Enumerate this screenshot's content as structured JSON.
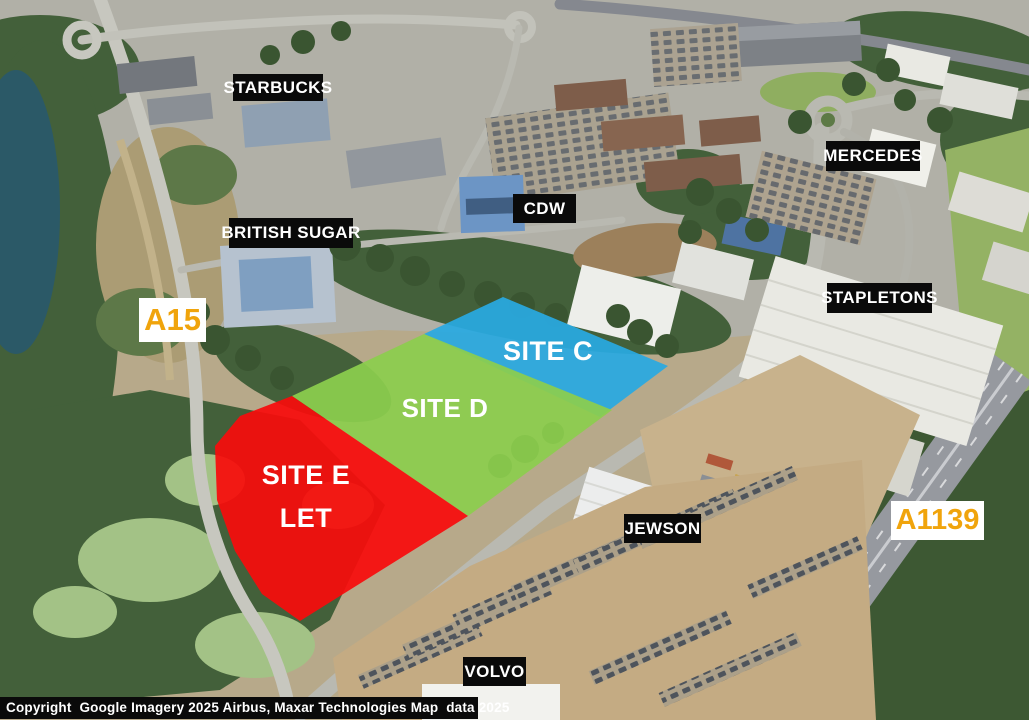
{
  "map": {
    "business_labels": [
      {
        "id": "starbucks",
        "text": "STARBUCKS"
      },
      {
        "id": "british-sugar",
        "text": "BRITISH SUGAR"
      },
      {
        "id": "cdw",
        "text": "CDW"
      },
      {
        "id": "mercedes",
        "text": "MERCEDES"
      },
      {
        "id": "stapletons",
        "text": "STAPLETONS"
      },
      {
        "id": "jewson",
        "text": "JEWSON"
      },
      {
        "id": "volvo",
        "text": "VOLVO"
      }
    ],
    "road_labels": [
      {
        "id": "a15",
        "text": "A15"
      },
      {
        "id": "a1139",
        "text": "A1139"
      }
    ],
    "sites": [
      {
        "name": "Site C",
        "label": "SITE C",
        "color": "#29A9E1",
        "points": "424,334 503,297 668,366 600,417"
      },
      {
        "name": "Site D",
        "label": "SITE D",
        "color": "#8CCE4D",
        "points": "292,396 424,334 612,410 468,516"
      },
      {
        "name": "Site E",
        "label": "SITE E",
        "sublabel": "LET",
        "color": "#F80C0C",
        "points": "292,396 468,516 300,621 262,594 235,551 217,500 215,446 240,416"
      }
    ],
    "colors": {
      "label_bg": "#0a0a0a",
      "label_text": "#ffffff",
      "road_label_text": "#F0A40C",
      "road_label_bg": "#ffffff",
      "site_label_text": "#ffffff",
      "water": "#2b5967",
      "woodland": "#43603a"
    },
    "copyright": "Copyright  Google Imagery 2025 Airbus, Maxar Technologies Map  data 2025"
  }
}
